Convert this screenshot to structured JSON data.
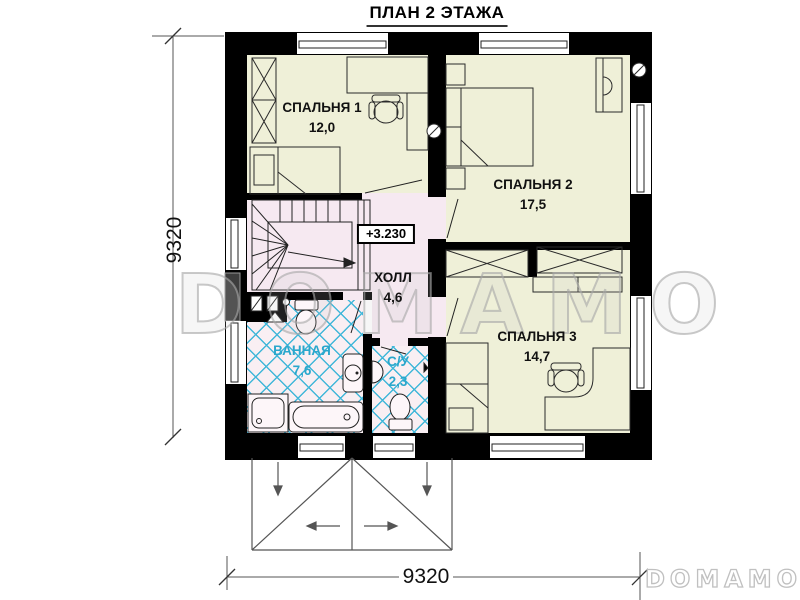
{
  "title": "ПЛАН 2 ЭТАЖА",
  "rooms": [
    {
      "name": "СПАЛЬНЯ 1",
      "area": "12,0"
    },
    {
      "name": "СПАЛЬНЯ 2",
      "area": "17,5"
    },
    {
      "name": "СПАЛЬНЯ 3",
      "area": "14,7"
    },
    {
      "name": "ХОЛЛ",
      "area": "4,6"
    },
    {
      "name": "ВАННАЯ",
      "area": "7,6"
    },
    {
      "name": "С/У",
      "area": "2,3"
    }
  ],
  "elevation_mark": "+3.230",
  "dimensions": {
    "left": "9320",
    "bottom": "9320"
  },
  "watermark": "DOMAMO",
  "logo": "DOMAMO",
  "colors": {
    "wall": "#000000",
    "bedroom_floor": "#EFF0D8",
    "hall_floor": "#F6E9F1",
    "tile_bg": "#F9EFF3",
    "tile_line": "#41B7D9",
    "accent_text": "#2AA7CC",
    "dim": "#555555",
    "watermark": "#C9C9C9"
  }
}
